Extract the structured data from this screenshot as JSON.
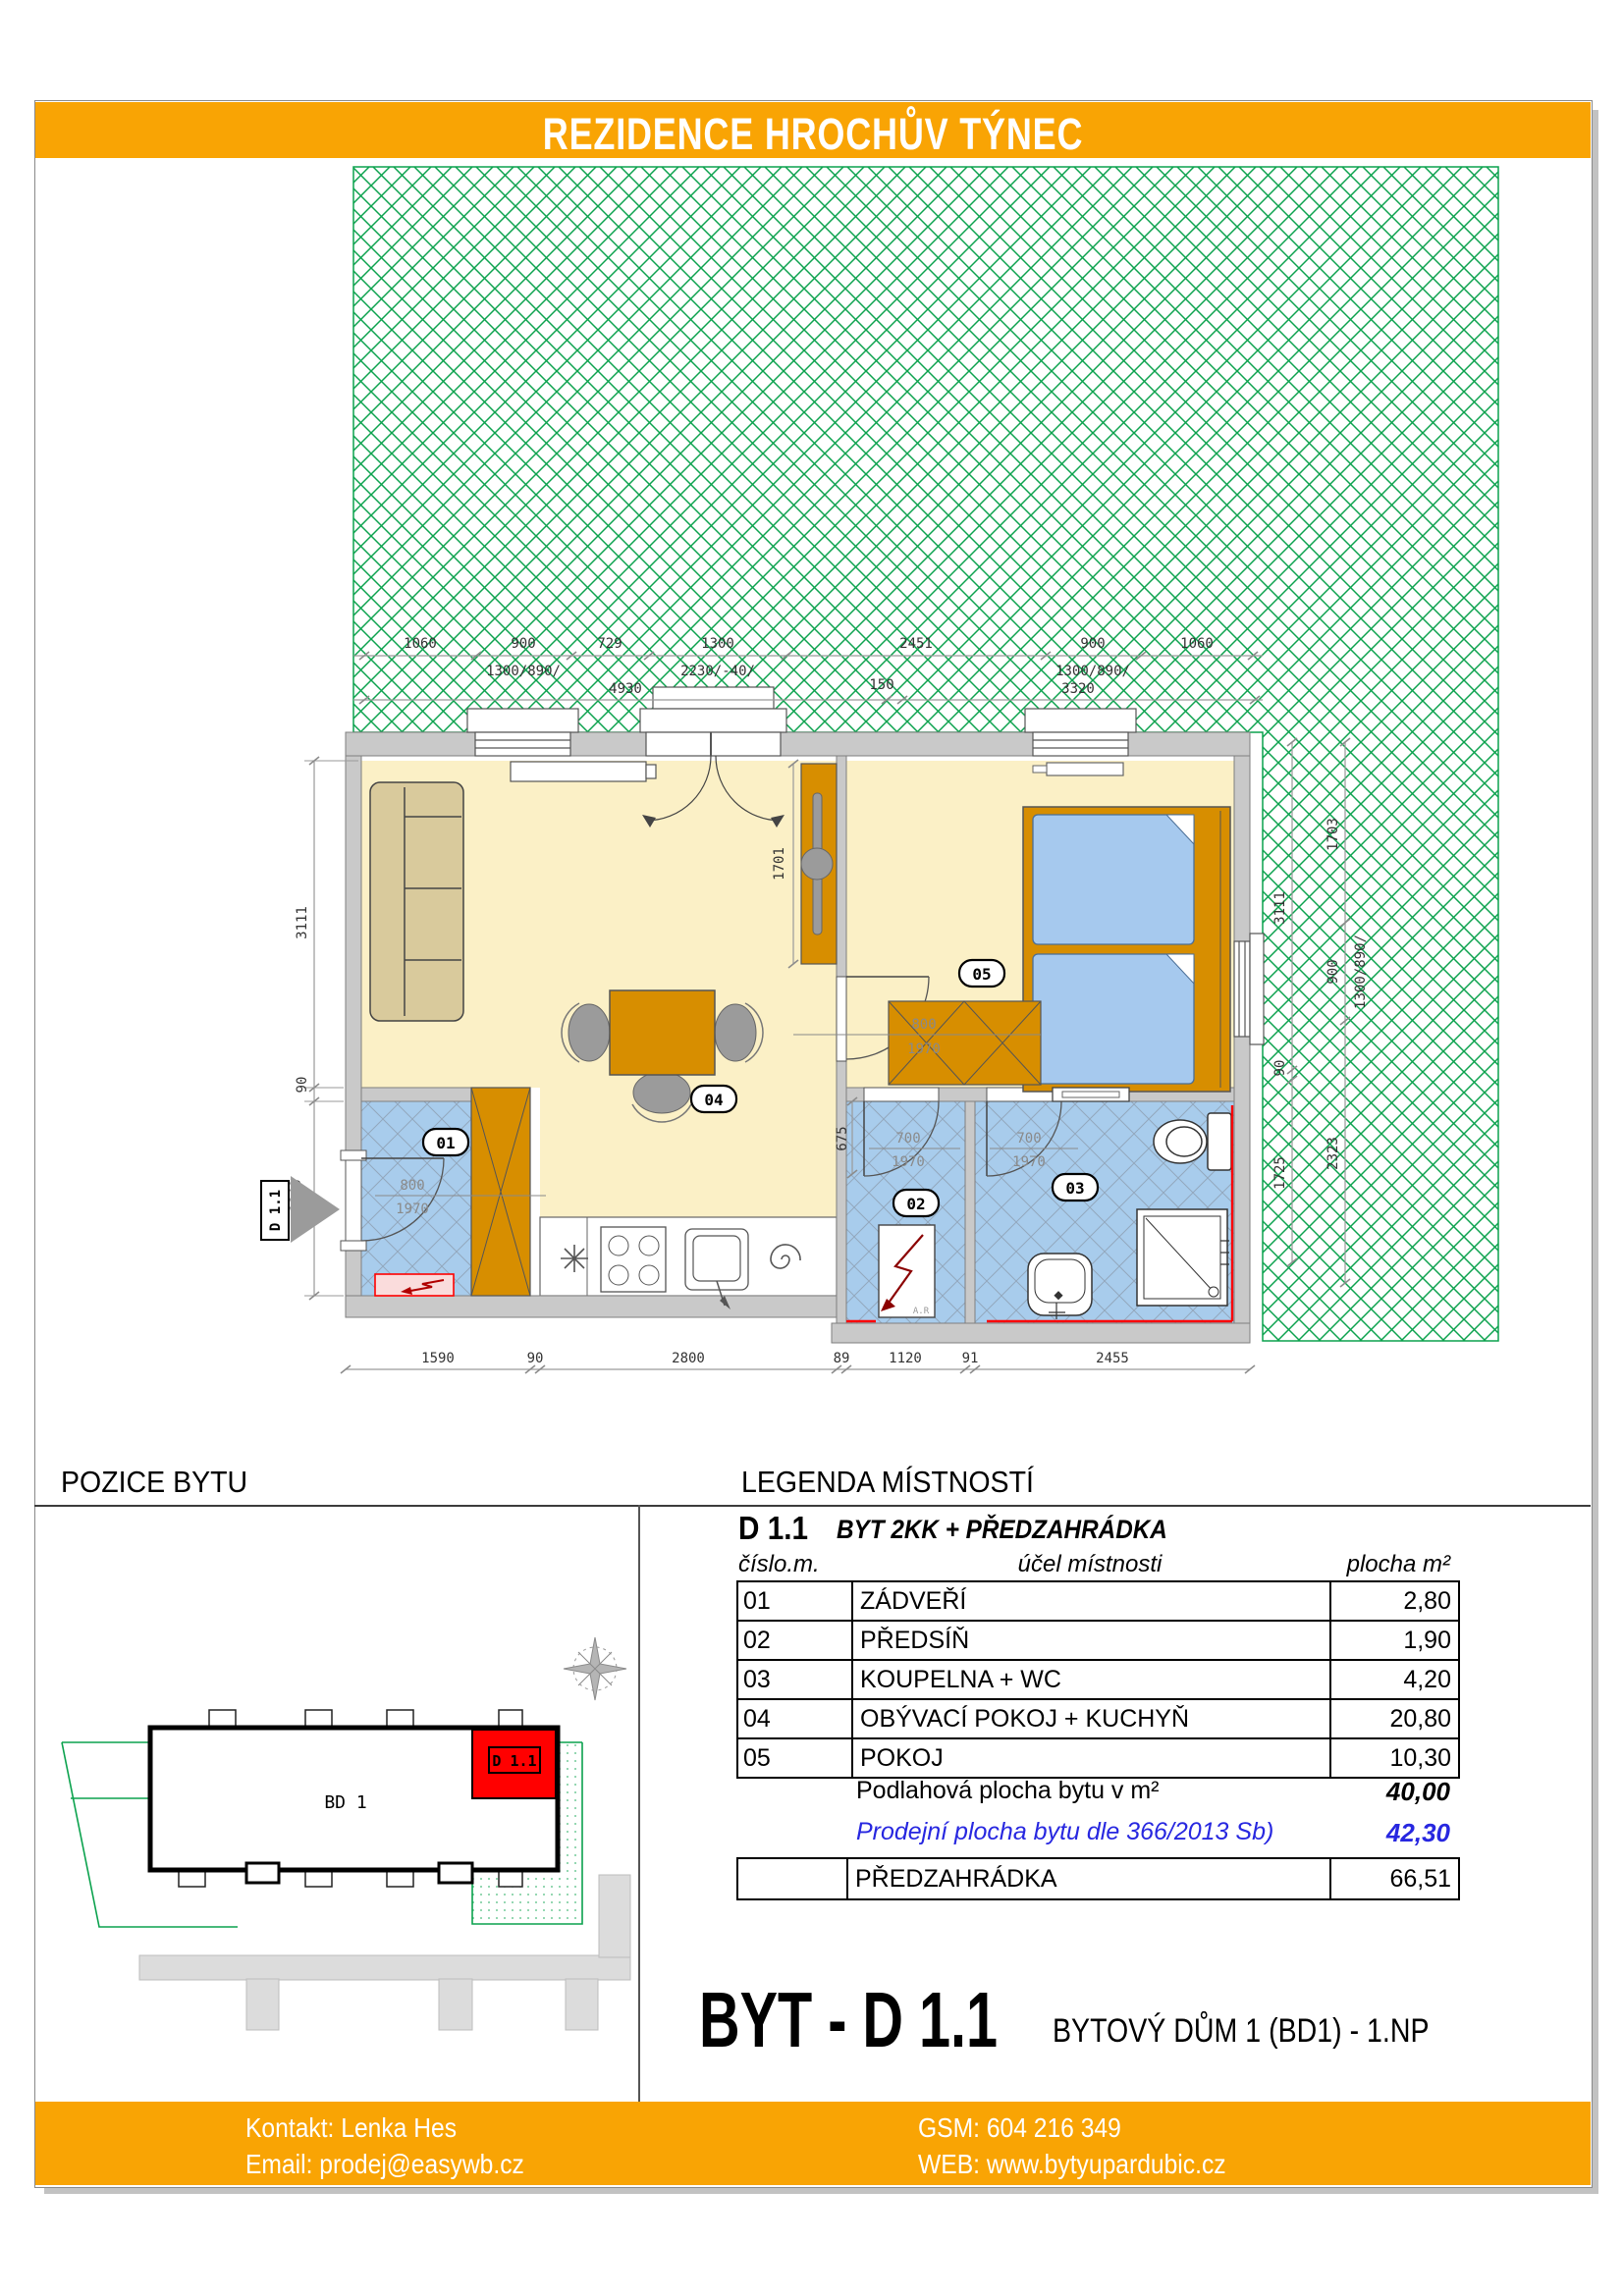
{
  "header": {
    "title": "REZIDENCE HROCHŮV TÝNEC"
  },
  "colors": {
    "accent": "#F9A404",
    "garden_green": "#0CA24E",
    "highlight_red": "#FF0000",
    "floor_cream": "#FBF0C6",
    "tile_blue": "#A8CCEC",
    "furniture_orange": "#D78E00",
    "wall_gray": "#C9C9C9",
    "bed_blue": "#A6C9EE"
  },
  "floorplan": {
    "dims_top": [
      "1060",
      "900",
      "729",
      "1300",
      "2451",
      "900",
      "1060"
    ],
    "dims_top_sub": [
      "1300/890/",
      "2230/-40/",
      "1300/890/"
    ],
    "dims_top2": [
      "4930",
      "150",
      "3320"
    ],
    "dims_left": [
      "3111",
      "90",
      "1840"
    ],
    "dims_bottom": [
      "1590",
      "90",
      "2800",
      "89",
      "1120",
      "91",
      "2455"
    ],
    "dims_right_a": [
      "3111",
      "90",
      "1725"
    ],
    "dims_right_b": [
      "1703",
      "900",
      "1300/890/",
      "2323"
    ],
    "dim_tv": "1701",
    "dim_hall": "675",
    "doors": {
      "entry_w": "800",
      "entry_h": "1970",
      "bedroom_w": "800",
      "bedroom_h": "1970",
      "hall_w": "700",
      "hall_h": "1970",
      "bath_w": "700",
      "bath_h": "1970"
    },
    "rooms": [
      "01",
      "02",
      "03",
      "04",
      "05"
    ],
    "unit_marker": "D 1.1"
  },
  "position": {
    "title": "POZICE BYTU",
    "building": "BD 1",
    "unit": "D 1.1"
  },
  "legend": {
    "title": "LEGENDA MÍSTNOSTÍ",
    "unit": "D 1.1",
    "subtitle": "BYT 2KK + PŘEDZAHRÁDKA",
    "col_no": "číslo.m.",
    "col_name": "účel místnosti",
    "col_area": "plocha m²",
    "rows": [
      {
        "no": "01",
        "name": "ZÁDVEŘÍ",
        "area": "2,80"
      },
      {
        "no": "02",
        "name": "PŘEDSÍŇ",
        "area": "1,90"
      },
      {
        "no": "03",
        "name": "KOUPELNA + WC",
        "area": "4,20"
      },
      {
        "no": "04",
        "name": "OBÝVACÍ POKOJ + KUCHYŇ",
        "area": "20,80"
      },
      {
        "no": "05",
        "name": "POKOJ",
        "area": "10,30"
      }
    ],
    "floor_label": "Podlahová plocha bytu v m²",
    "floor_value": "40,00",
    "sale_label": "Prodejní plocha bytu dle 366/2013 Sb)",
    "sale_value": "42,30",
    "garden_label": "PŘEDZAHRÁDKA",
    "garden_value": "66,51"
  },
  "titleblock": {
    "apartment": "BYT - D 1.1",
    "building": "BYTOVÝ DŮM 1 (BD1)  -  1.NP"
  },
  "footer": {
    "contact": "Kontakt: Lenka Hes",
    "email": "Email: prodej@easywb.cz",
    "gsm": "GSM: 604 216 349",
    "web": "WEB: www.bytyupardubic.cz"
  }
}
